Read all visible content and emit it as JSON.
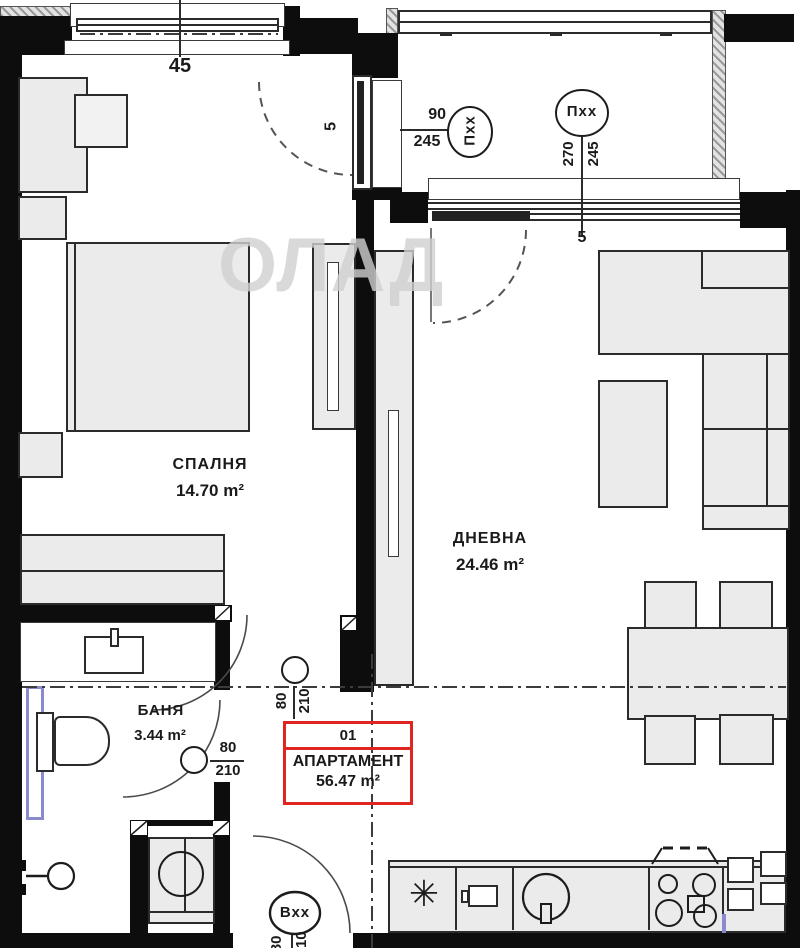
{
  "watermark": "ОЛАД",
  "rooms": {
    "bedroom": {
      "name": "СПАЛНЯ",
      "area": "14.70 m²"
    },
    "living": {
      "name": "ДНЕВНА",
      "area": "24.46 m²"
    },
    "bath": {
      "name": "БАНЯ",
      "area": "3.44 m²"
    }
  },
  "apartment": {
    "number": "01",
    "label": "АПАРТАМЕНТ",
    "area": "56.47 m²"
  },
  "dims": {
    "top_window_width": "45",
    "bedroom_window_gap": "5",
    "living_window_gap": "5"
  },
  "openings": {
    "window_bedroom": {
      "tag": "Пхх",
      "width": "90",
      "height": "245"
    },
    "window_living": {
      "tag": "Пхх",
      "width": "270",
      "height": "245"
    },
    "door_bedroom": {
      "width": "80",
      "height": "210"
    },
    "door_bath": {
      "width": "80",
      "height": "210"
    },
    "door_entry": {
      "tag": "Вхх",
      "width": "80",
      "height": "210"
    }
  },
  "icons": {
    "fridge": "✳"
  },
  "colors": {
    "wall": "#0d0d0d",
    "accent_red": "#e02420",
    "accent_blue": "#8a8ace",
    "furniture_fill": "#ebebeb"
  }
}
